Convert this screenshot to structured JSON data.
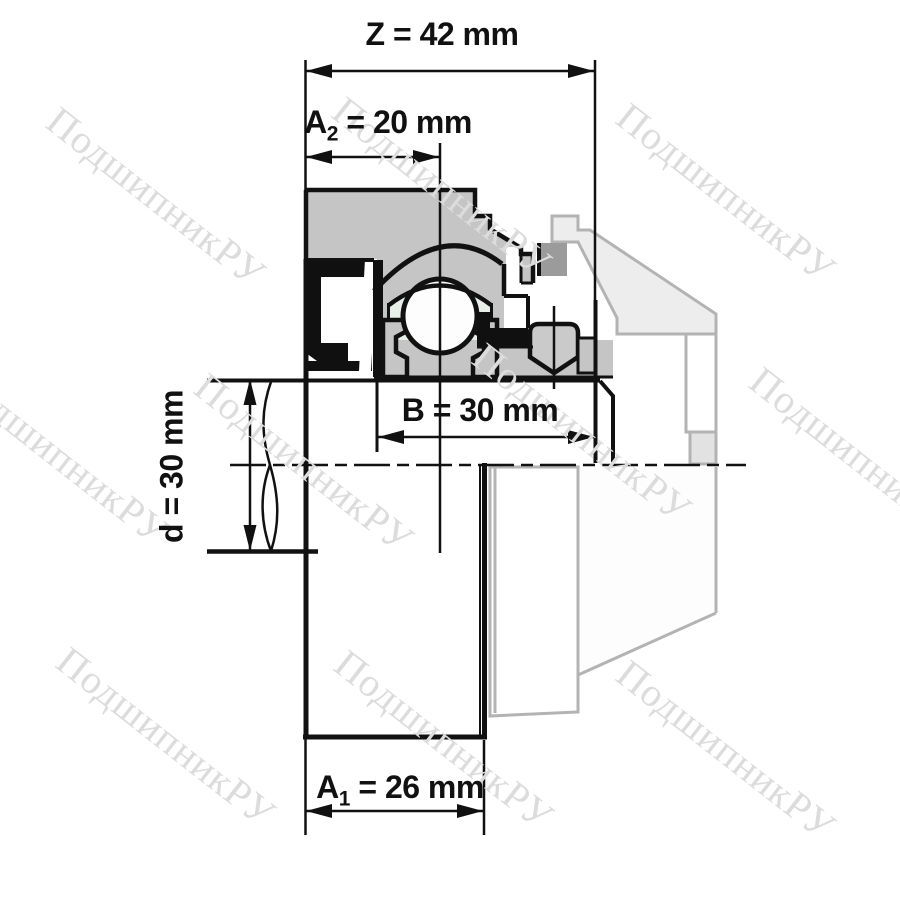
{
  "title": "Bearing unit dimensional drawing",
  "watermark": {
    "text": "ПодшипникРУ"
  },
  "dimensions": {
    "Z": {
      "prefix": "Z",
      "sub": "",
      "rest": " = 42 mm",
      "value_mm": 42
    },
    "A2": {
      "prefix": "A",
      "sub": "2",
      "rest": " = 20 mm",
      "value_mm": 20
    },
    "B": {
      "prefix": "B",
      "sub": "",
      "rest": " = 30 mm",
      "value_mm": 30
    },
    "A1": {
      "prefix": "A",
      "sub": "1",
      "rest": " = 26 mm",
      "value_mm": 26
    },
    "d": {
      "prefix": "d",
      "sub": "",
      "rest": " = 30 mm",
      "value_mm": 30
    }
  },
  "colors": {
    "line": "#111111",
    "section_gray": "#c5c5c5",
    "dark_overlap_gray": "#9b9b9b",
    "phantom_fill": "#ededed",
    "phantom_stroke": "#b3b3b3",
    "cage_mint": "#e8efe8",
    "watermark_gray": "#dcdcdc"
  }
}
